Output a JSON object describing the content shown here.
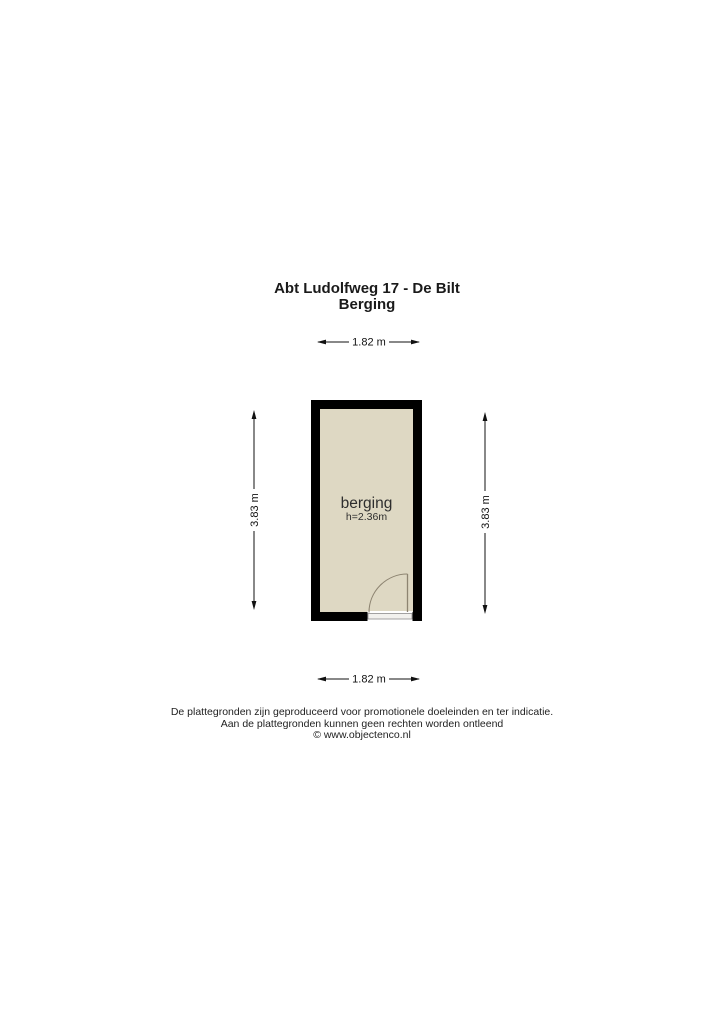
{
  "header": {
    "address": "Abt Ludolfweg 17 - De Bilt",
    "floor": "Berging"
  },
  "floorplan": {
    "room": {
      "name": "berging",
      "ceiling_height": "h=2.36m"
    },
    "dimensions": {
      "top_width": "1.82 m",
      "bottom_width": "1.82 m",
      "left_height": "3.83 m",
      "right_height": "3.83 m"
    },
    "colors": {
      "wall": "#000000",
      "floor": "#ded8c3",
      "door": "#8d8471",
      "threshold_fill": "#f2f1ee",
      "threshold_stroke": "#8c8c8c"
    }
  },
  "footer": {
    "line1": "De plattegronden zijn geproduceerd voor promotionele doeleinden en ter indicatie.",
    "line2": "Aan de plattegronden kunnen geen rechten worden ontleend",
    "line3": "© www.objectenco.nl"
  }
}
